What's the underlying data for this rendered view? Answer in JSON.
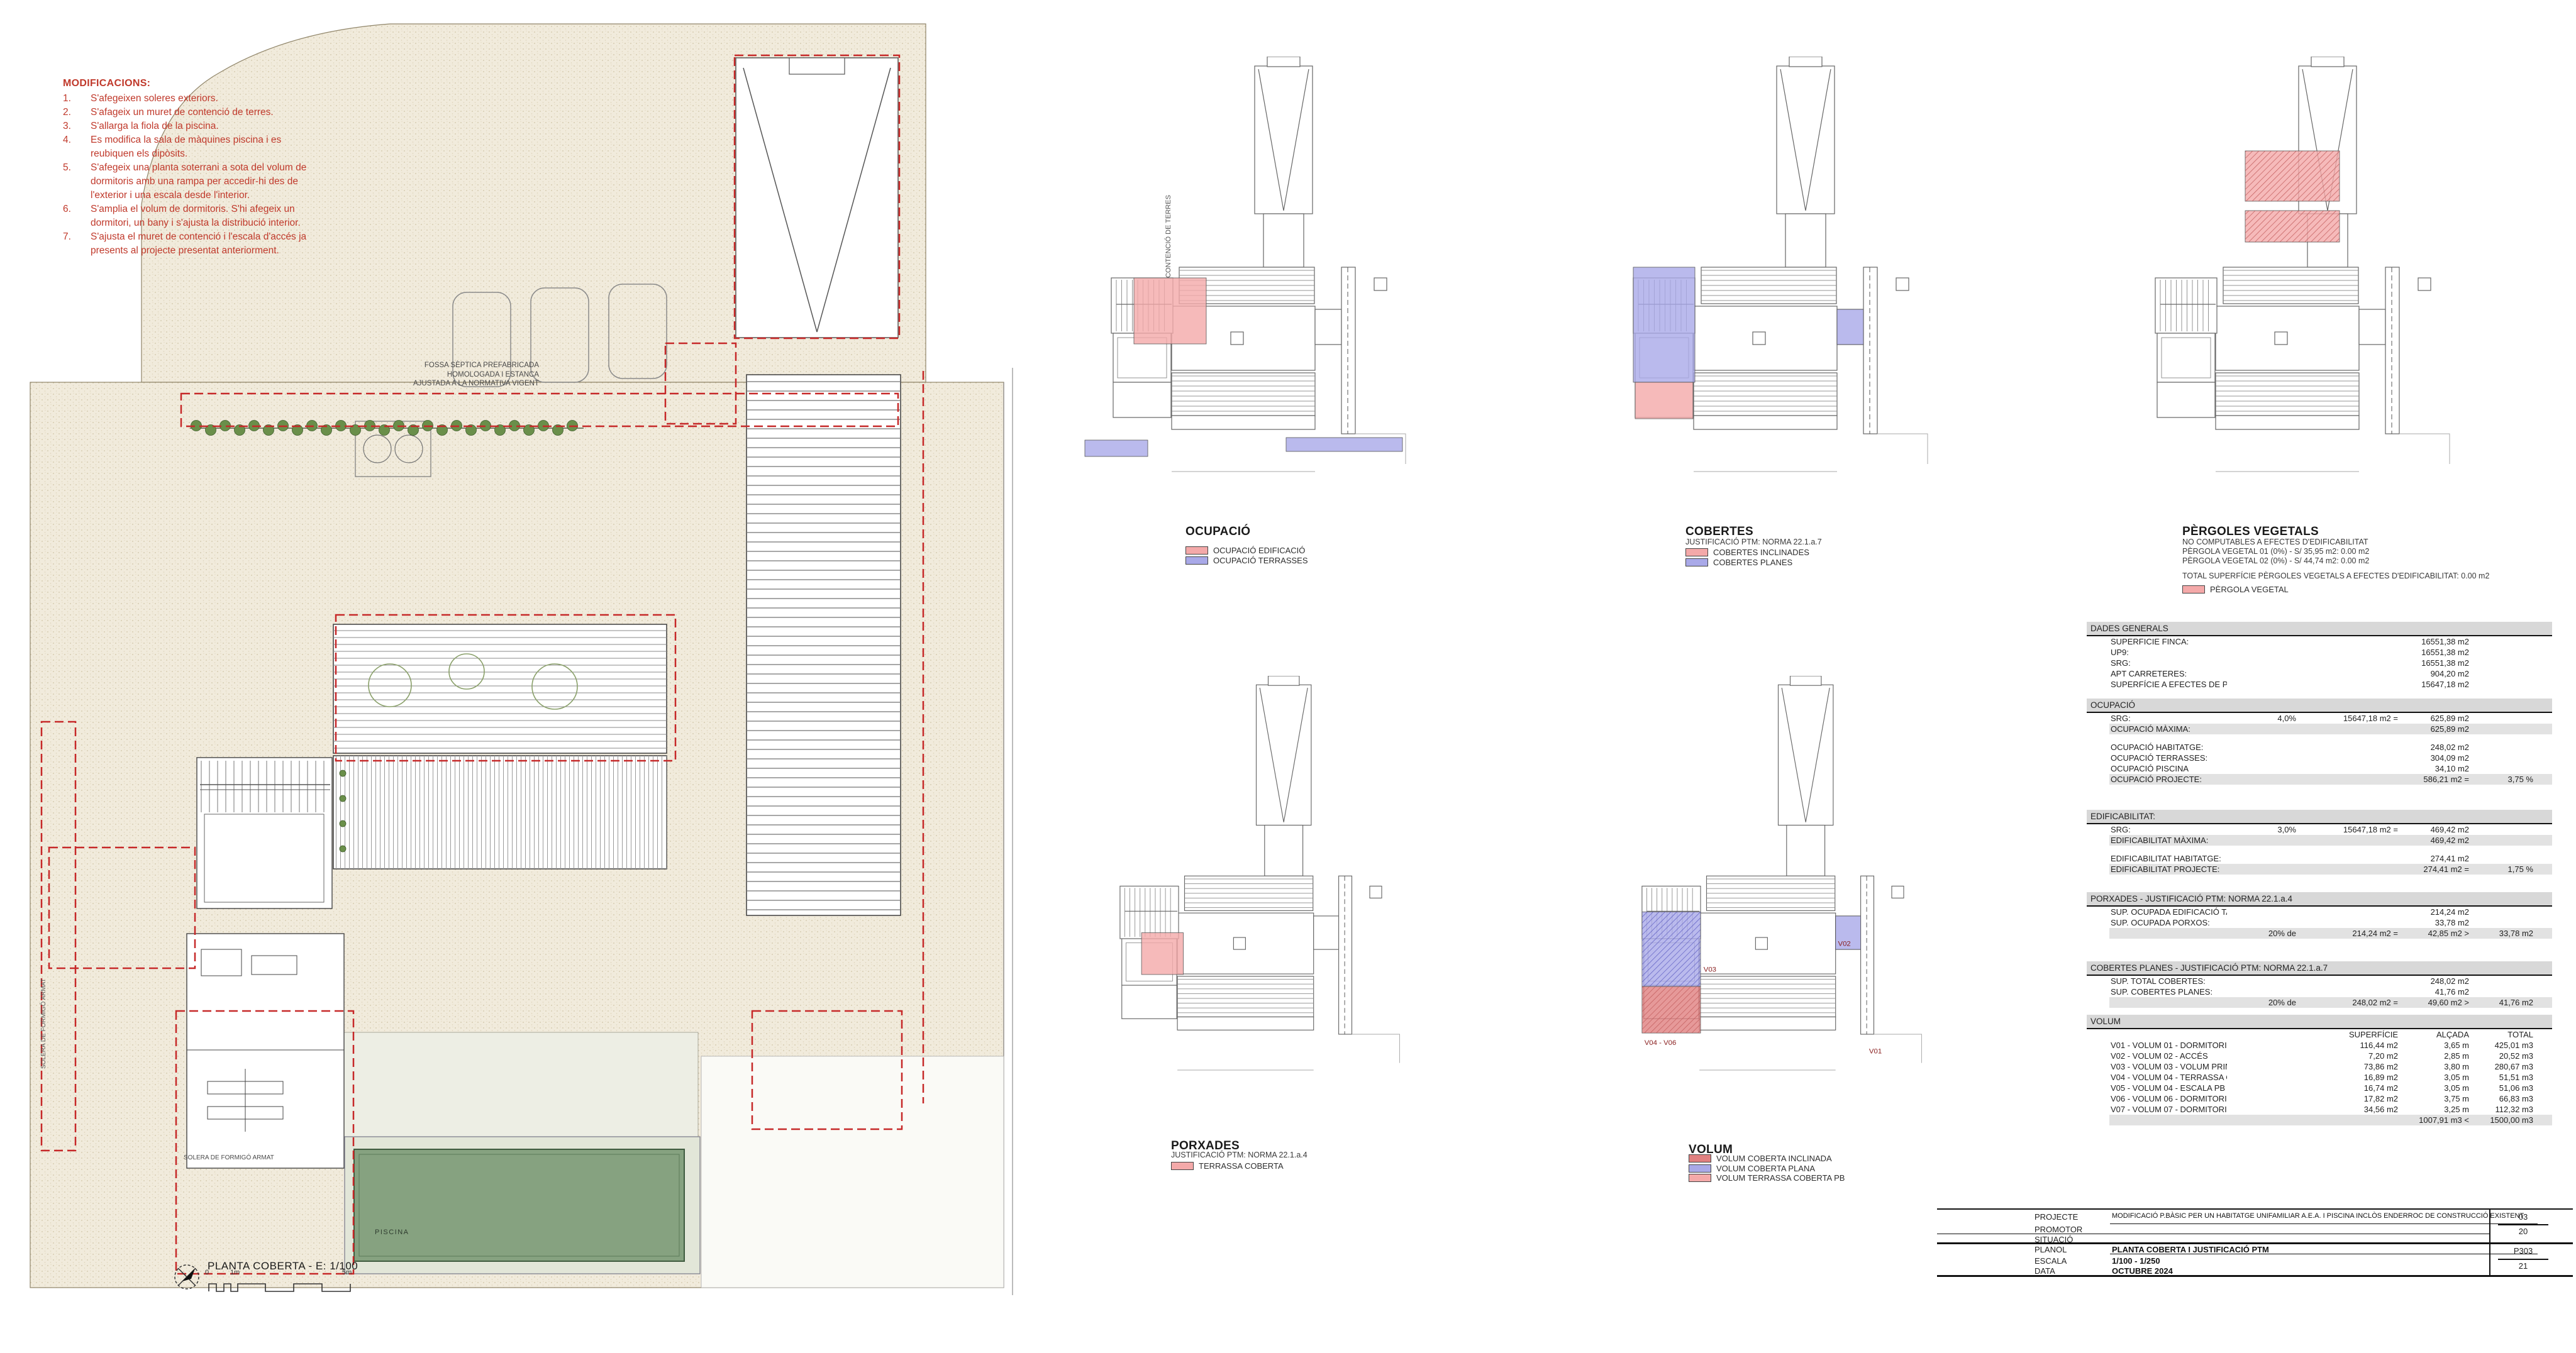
{
  "colors": {
    "annotation_red": "#c0392b",
    "dashed_red": "#c62828",
    "overlay_pink": "#f4a9a9",
    "overlay_blue": "#a9a9e8",
    "overlay_red": "#e08080",
    "pool_green": "#86a280",
    "hedge_green": "#6a8f4a",
    "site_beige": "#f1ebdc",
    "table_header_bg": "#d8d8d8",
    "table_shade_bg": "#e2e2e2"
  },
  "modifications": {
    "title": "MODIFICACIONS:",
    "items": [
      {
        "n": "1.",
        "t": "S'afegeixen soleres exteriors."
      },
      {
        "n": "2.",
        "t": "S'afageix un muret de contenció de terres."
      },
      {
        "n": "3.",
        "t": "S'allarga la fiola de la piscina."
      },
      {
        "n": "4.",
        "t": "Es modifica la sala de màquines piscina i es reubiquen els dipòsits."
      },
      {
        "n": "5.",
        "t": "S'afegeix una planta soterrani a sota del volum de dormitoris amb una rampa per accedir-hi des de l'exterior i una escala desde l'interior."
      },
      {
        "n": "6.",
        "t": "S'amplia el volum de dormitoris. S'hi afegeix un dormitori, un bany i s'ajusta la distribució interior."
      },
      {
        "n": "7.",
        "t": "S'ajusta el muret de contenció i l'escala d'accés ja presents al projecte presentat anteriorment."
      }
    ]
  },
  "plan": {
    "title": "PLANTA COBERTA - E: 1/100",
    "scale_marks": [
      "0",
      "1m",
      "5m"
    ],
    "labels": {
      "fossa": "FOSSA SÈPTICA PREFABRICADA\nHOMOLOGADA I ESTANCA\nAJUSTADA A LA NORMATIVA VIGENT",
      "piscina": "PISCINA",
      "solera_left": "SOLERA DE FORMIGÓ ARMAT",
      "solera_bottom": "SOLERA DE FORMIGÓ ARMAT",
      "mur": "MUR CONTENCIÓ DE TERRES"
    }
  },
  "diagrams": [
    {
      "id": "ocupacio",
      "title": "OCUPACIÓ",
      "subtitle": "",
      "notes": [],
      "legend": [
        {
          "label": "OCUPACIÓ EDIFICACIÓ",
          "color": "#f4a9a9"
        },
        {
          "label": "OCUPACIÓ TERRASSES",
          "color": "#a9a9e8"
        }
      ]
    },
    {
      "id": "cobertes",
      "title": "COBERTES",
      "subtitle": "JUSTIFICACIÓ PTM: NORMA 22.1.a.7",
      "notes": [],
      "legend": [
        {
          "label": "COBERTES INCLINADES",
          "color": "#f4a9a9"
        },
        {
          "label": "COBERTES PLANES",
          "color": "#a9a9e8"
        }
      ]
    },
    {
      "id": "pergoles",
      "title": "PÈRGOLES VEGETALS",
      "subtitle": "NO COMPUTABLES A EFECTES D'EDIFICABILITAT",
      "notes": [
        "PÈRGOLA VEGETAL 01 (0%) - S/ 35,95 m2: 0.00 m2",
        "PÈRGOLA VEGETAL 02 (0%) - S/ 44,74 m2: 0.00 m2",
        "",
        "TOTAL SUPERFÍCIE PÈRGOLES VEGETALS A EFECTES D'EDIFICABILITAT: 0.00 m2"
      ],
      "legend": [
        {
          "label": "PÈRGOLA VEGETAL",
          "color": "#f4a9a9"
        }
      ]
    },
    {
      "id": "porxades",
      "title": "PORXADES",
      "subtitle": "JUSTIFICACIÓ PTM: NORMA 22.1.a.4",
      "notes": [],
      "legend": [
        {
          "label": "TERRASSA COBERTA",
          "color": "#f4a9a9"
        }
      ]
    },
    {
      "id": "volum",
      "title": "VOLUM",
      "subtitle": "",
      "notes": [],
      "legend": [
        {
          "label": "VOLUM COBERTA INCLINADA",
          "color": "#e08080"
        },
        {
          "label": "VOLUM COBERTA PLANA",
          "color": "#a9a9e8"
        },
        {
          "label": "VOLUM TERRASSA COBERTA PB",
          "color": "#f4a9a9"
        }
      ],
      "marks": [
        "V01",
        "V02",
        "V03",
        "V04 - V06"
      ]
    }
  ],
  "tables": [
    {
      "title": "DADES GENERALS",
      "rows": [
        {
          "l": "SUPERFICIE FINCA:",
          "c3": "16551,38 m2"
        },
        {
          "l": "UP9:",
          "c3": "16551,38 m2"
        },
        {
          "l": "SRG:",
          "c3": "16551,38 m2"
        },
        {
          "l": "APT CARRETERES:",
          "c3": "904,20 m2"
        },
        {
          "l": "SUPERFÍCIE A EFECTES DE PARÀMETRES URBANÍSTICS",
          "c3": "15647,18 m2"
        }
      ]
    },
    {
      "title": "OCUPACIÓ",
      "rows": [
        {
          "l": "SRG:",
          "c1": "4,0%",
          "c2": "15647,18 m2 =",
          "c3": "625,89 m2"
        },
        {
          "l": "OCUPACIÓ MÀXIMA:",
          "c3": "625,89 m2",
          "sh": true
        },
        {
          "sp": true
        },
        {
          "l": "OCUPACIÓ HABITATGE:",
          "c3": "248,02 m2"
        },
        {
          "l": "OCUPACIÓ TERRASSES:",
          "c3": "304,09 m2"
        },
        {
          "l": "OCUPACIÓ PISCINA",
          "c3": "34,10 m2"
        },
        {
          "l": "OCUPACIÓ PROJECTE:",
          "c3": "586,21 m2 =",
          "c4": "3,75 %",
          "sh": true
        }
      ]
    },
    {
      "title": "EDIFICABILITAT:",
      "rows": [
        {
          "l": "SRG:",
          "c1": "3,0%",
          "c2": "15647,18 m2 =",
          "c3": "469,42 m2"
        },
        {
          "l": "EDIFICABILITAT MÀXIMA:",
          "c3": "469,42 m2",
          "sh": true
        },
        {
          "sp": true
        },
        {
          "l": "EDIFICABILITAT HABITATGE:",
          "c3": "274,41 m2"
        },
        {
          "l": "EDIFICABILITAT PROJECTE:",
          "c3": "274,41 m2 =",
          "c4": "1,75 %",
          "sh": true
        }
      ]
    },
    {
      "title": "PORXADES - JUSTIFICACIÓ PTM: NORMA 22.1.a.4",
      "rows": [
        {
          "l": "SUP. OCUPADA EDIFICACIÓ TANCADA:",
          "c3": "214,24 m2"
        },
        {
          "l": "SUP. OCUPADA PORXOS:",
          "c3": "33,78 m2"
        },
        {
          "c1": "20% de",
          "c2": "214,24 m2 =",
          "c3": "42,85 m2 >",
          "c4": "33,78 m2",
          "sh": true
        }
      ]
    },
    {
      "title": "COBERTES PLANES - JUSTIFICACIÓ PTM: NORMA 22.1.a.7",
      "rows": [
        {
          "l": "SUP. TOTAL COBERTES:",
          "c3": "248,02 m2"
        },
        {
          "l": "SUP. COBERTES PLANES:",
          "c3": "41,76 m2"
        },
        {
          "c1": "20% de",
          "c2": "248,02 m2 =",
          "c3": "49,60 m2 >",
          "c4": "41,76 m2",
          "sh": true
        }
      ]
    },
    {
      "title": "VOLUM",
      "rows": [
        {
          "hd": true,
          "c2": "SUPERFÍCIE",
          "c3": "ALÇADA",
          "c4": "TOTAL"
        },
        {
          "l": "V01 - VOLUM 01 - DORMITORIS",
          "c2": "116,44 m2",
          "c3": "3,65 m",
          "c4": "425,01 m3"
        },
        {
          "l": "V02 - VOLUM 02 - ACCÉS",
          "c2": "7,20 m2",
          "c3": "2,85 m",
          "c4": "20,52 m3"
        },
        {
          "l": "V03 - VOLUM 03 - VOLUM PRINCIPAL",
          "c2": "73,86 m2",
          "c3": "3,80 m",
          "c4": "280,67 m3"
        },
        {
          "l": "V04 - VOLUM 04 - TERRASSA COBERTA PB",
          "c2": "16,89 m2",
          "c3": "3,05 m",
          "c4": "51,51 m3"
        },
        {
          "l": "V05 - VOLUM 04 - ESCALA PB",
          "c2": "16,74 m2",
          "c3": "3,05 m",
          "c4": "51,06 m3"
        },
        {
          "l": "V06 - VOLUM 06 - DORMITORI PP1 COBERTA INCLINADA",
          "c2": "17,82 m2",
          "c3": "3,75 m",
          "c4": "66,83 m3"
        },
        {
          "l": "V07 - VOLUM 07 - DORMITORI  PP1 COBERTA PLANA",
          "c2": "34,56 m2",
          "c3": "3,25 m",
          "c4": "112,32 m3"
        },
        {
          "c3": "1007,91 m3 <",
          "c4": "1500,00 m3",
          "sh": true
        }
      ]
    }
  ],
  "titleblock": {
    "rows": [
      {
        "label": "PROJECTE",
        "value": "MODIFICACIÓ P.BÀSIC PER UN HABITATGE UNIFAMILIAR A.E.A. I PISCINA INCLÒS ENDERROC DE CONSTRUCCIÓ EXISTENT"
      },
      {
        "label": "PROMOTOR",
        "value": ""
      },
      {
        "label": "SITUACIÓ",
        "value": ""
      },
      {
        "label": "PLANOL",
        "value": "PLANTA COBERTA I JUSTIFICACIÓ PTM"
      },
      {
        "label": "ESCALA",
        "value": "1/100 - 1/250"
      },
      {
        "label": "DATA",
        "value": "OCTUBRE 2024"
      }
    ],
    "sheet_number": "03",
    "sheet_total": "20",
    "plan_code": "P303",
    "plan_code_den": "21"
  }
}
